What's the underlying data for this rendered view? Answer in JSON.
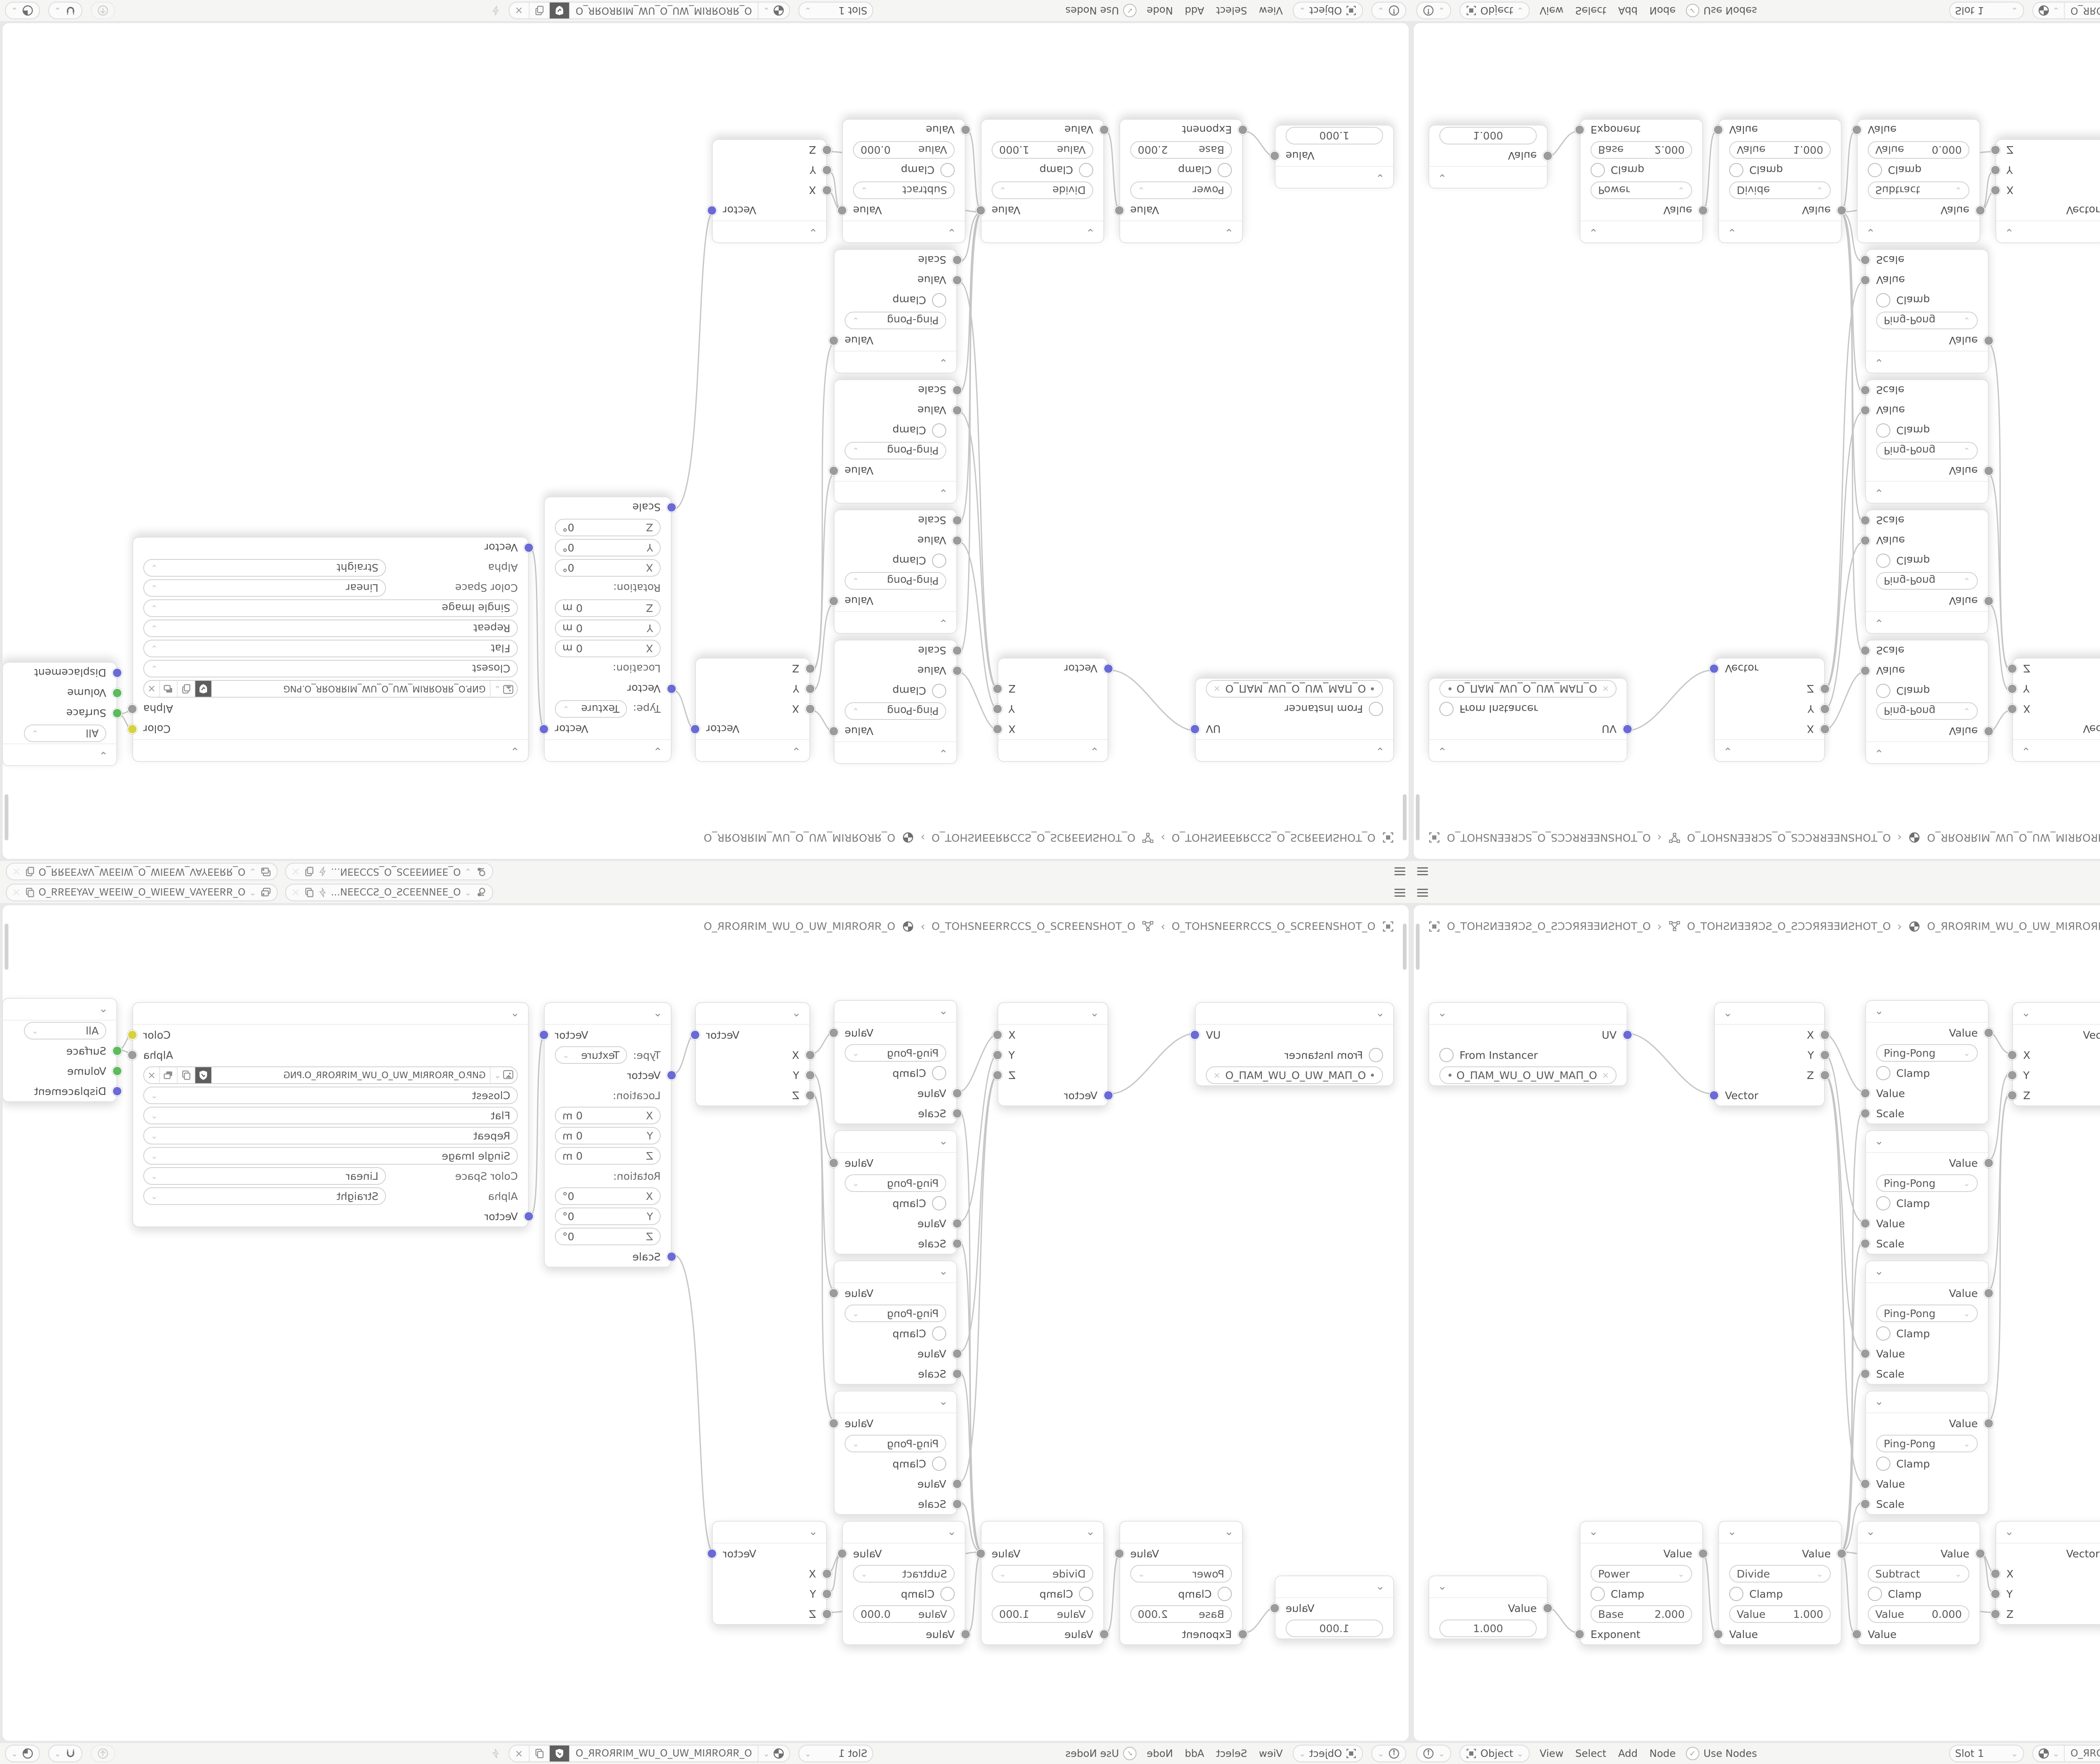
{
  "icons": {
    "chevron": "⌄",
    "close": "×",
    "check": "✓",
    "bullet": "•",
    "crumb_sep": "›"
  },
  "topbar": {
    "scene_name": "O_ƎƎИИƎƎƆS_O_SƆƆƎƎИ...",
    "view_layer_name": "O_ЯЯƎƎYAV_WƎƎIW_O_WIƎƎW_VAYƎƎЯЯ_O"
  },
  "breadcrumb": {
    "scene": "O_TOHƧИƎƎЯƆƧ_O_ƧƆƆЯЯƎƎИƧHOT_O",
    "object": "O_TOHƧИƎƎЯƆƧ_O_ƧƆƆЯЯƎƎИƧHOT_O",
    "material": "O_ЯROЯRIM_WU_O_UW_MIЯROЯR_O"
  },
  "header": {
    "mode": "Object",
    "menus": {
      "view": "View",
      "select": "Select",
      "add": "Add",
      "node": "Node"
    },
    "use_nodes": "Use Nodes",
    "slot": "Slot 1",
    "material": "O_ЯROЯRIM_WU_O_UW_MIЯROЯR_O"
  },
  "labels": {
    "value": "Value",
    "vector": "Vector",
    "scale": "Scale",
    "clamp": "Clamp",
    "x": "X",
    "y": "Y",
    "z": "Z",
    "uv": "UV"
  },
  "nodes": {
    "uv_map": {
      "from_instancer": "From Instancer",
      "map_name": "O_ПAM_WU_O_UW_MAП_O"
    },
    "math_pingpong": {
      "operation": "Ping-Pong"
    },
    "mapping": {
      "type_label": "Type:",
      "type": "Texture",
      "location_label": "Location:",
      "rotation_label": "Rotation:",
      "location_value": "0 m",
      "rotation_value": "0°"
    },
    "image_texture": {
      "filename": "GИP.O_ЯROЯRIM_WU_O_UW_MIЯROЯR_O.PNG",
      "interpolation": "Closest",
      "projection": "Flat",
      "extension": "Repeat",
      "source": "Single Image",
      "color_space_label": "Color Space",
      "color_space": "Linear",
      "alpha_label": "Alpha",
      "alpha_mode": "Straight",
      "color_out": "Color",
      "alpha_out": "Alpha"
    },
    "material_output": {
      "target": "All",
      "surface": "Surface",
      "volume": "Volume",
      "displacement": "Displacement"
    },
    "value": {
      "value": "1.000"
    },
    "power": {
      "operation": "Power",
      "field_label": "Base",
      "field_value": "2.000",
      "input_label": "Exponent"
    },
    "divide": {
      "operation": "Divide",
      "field_label": "Value",
      "field_value": "1.000",
      "input_label": "Value"
    },
    "subtract": {
      "operation": "Subtract",
      "field_label": "Value",
      "field_value": "0.000",
      "input_label": "Value"
    }
  },
  "colors": {
    "wire": "#c6c6c6",
    "socket_vector": "#6a6ad6",
    "socket_value": "#9b9b9b",
    "socket_color": "#d6d23e",
    "socket_shader": "#5cbb5c"
  }
}
